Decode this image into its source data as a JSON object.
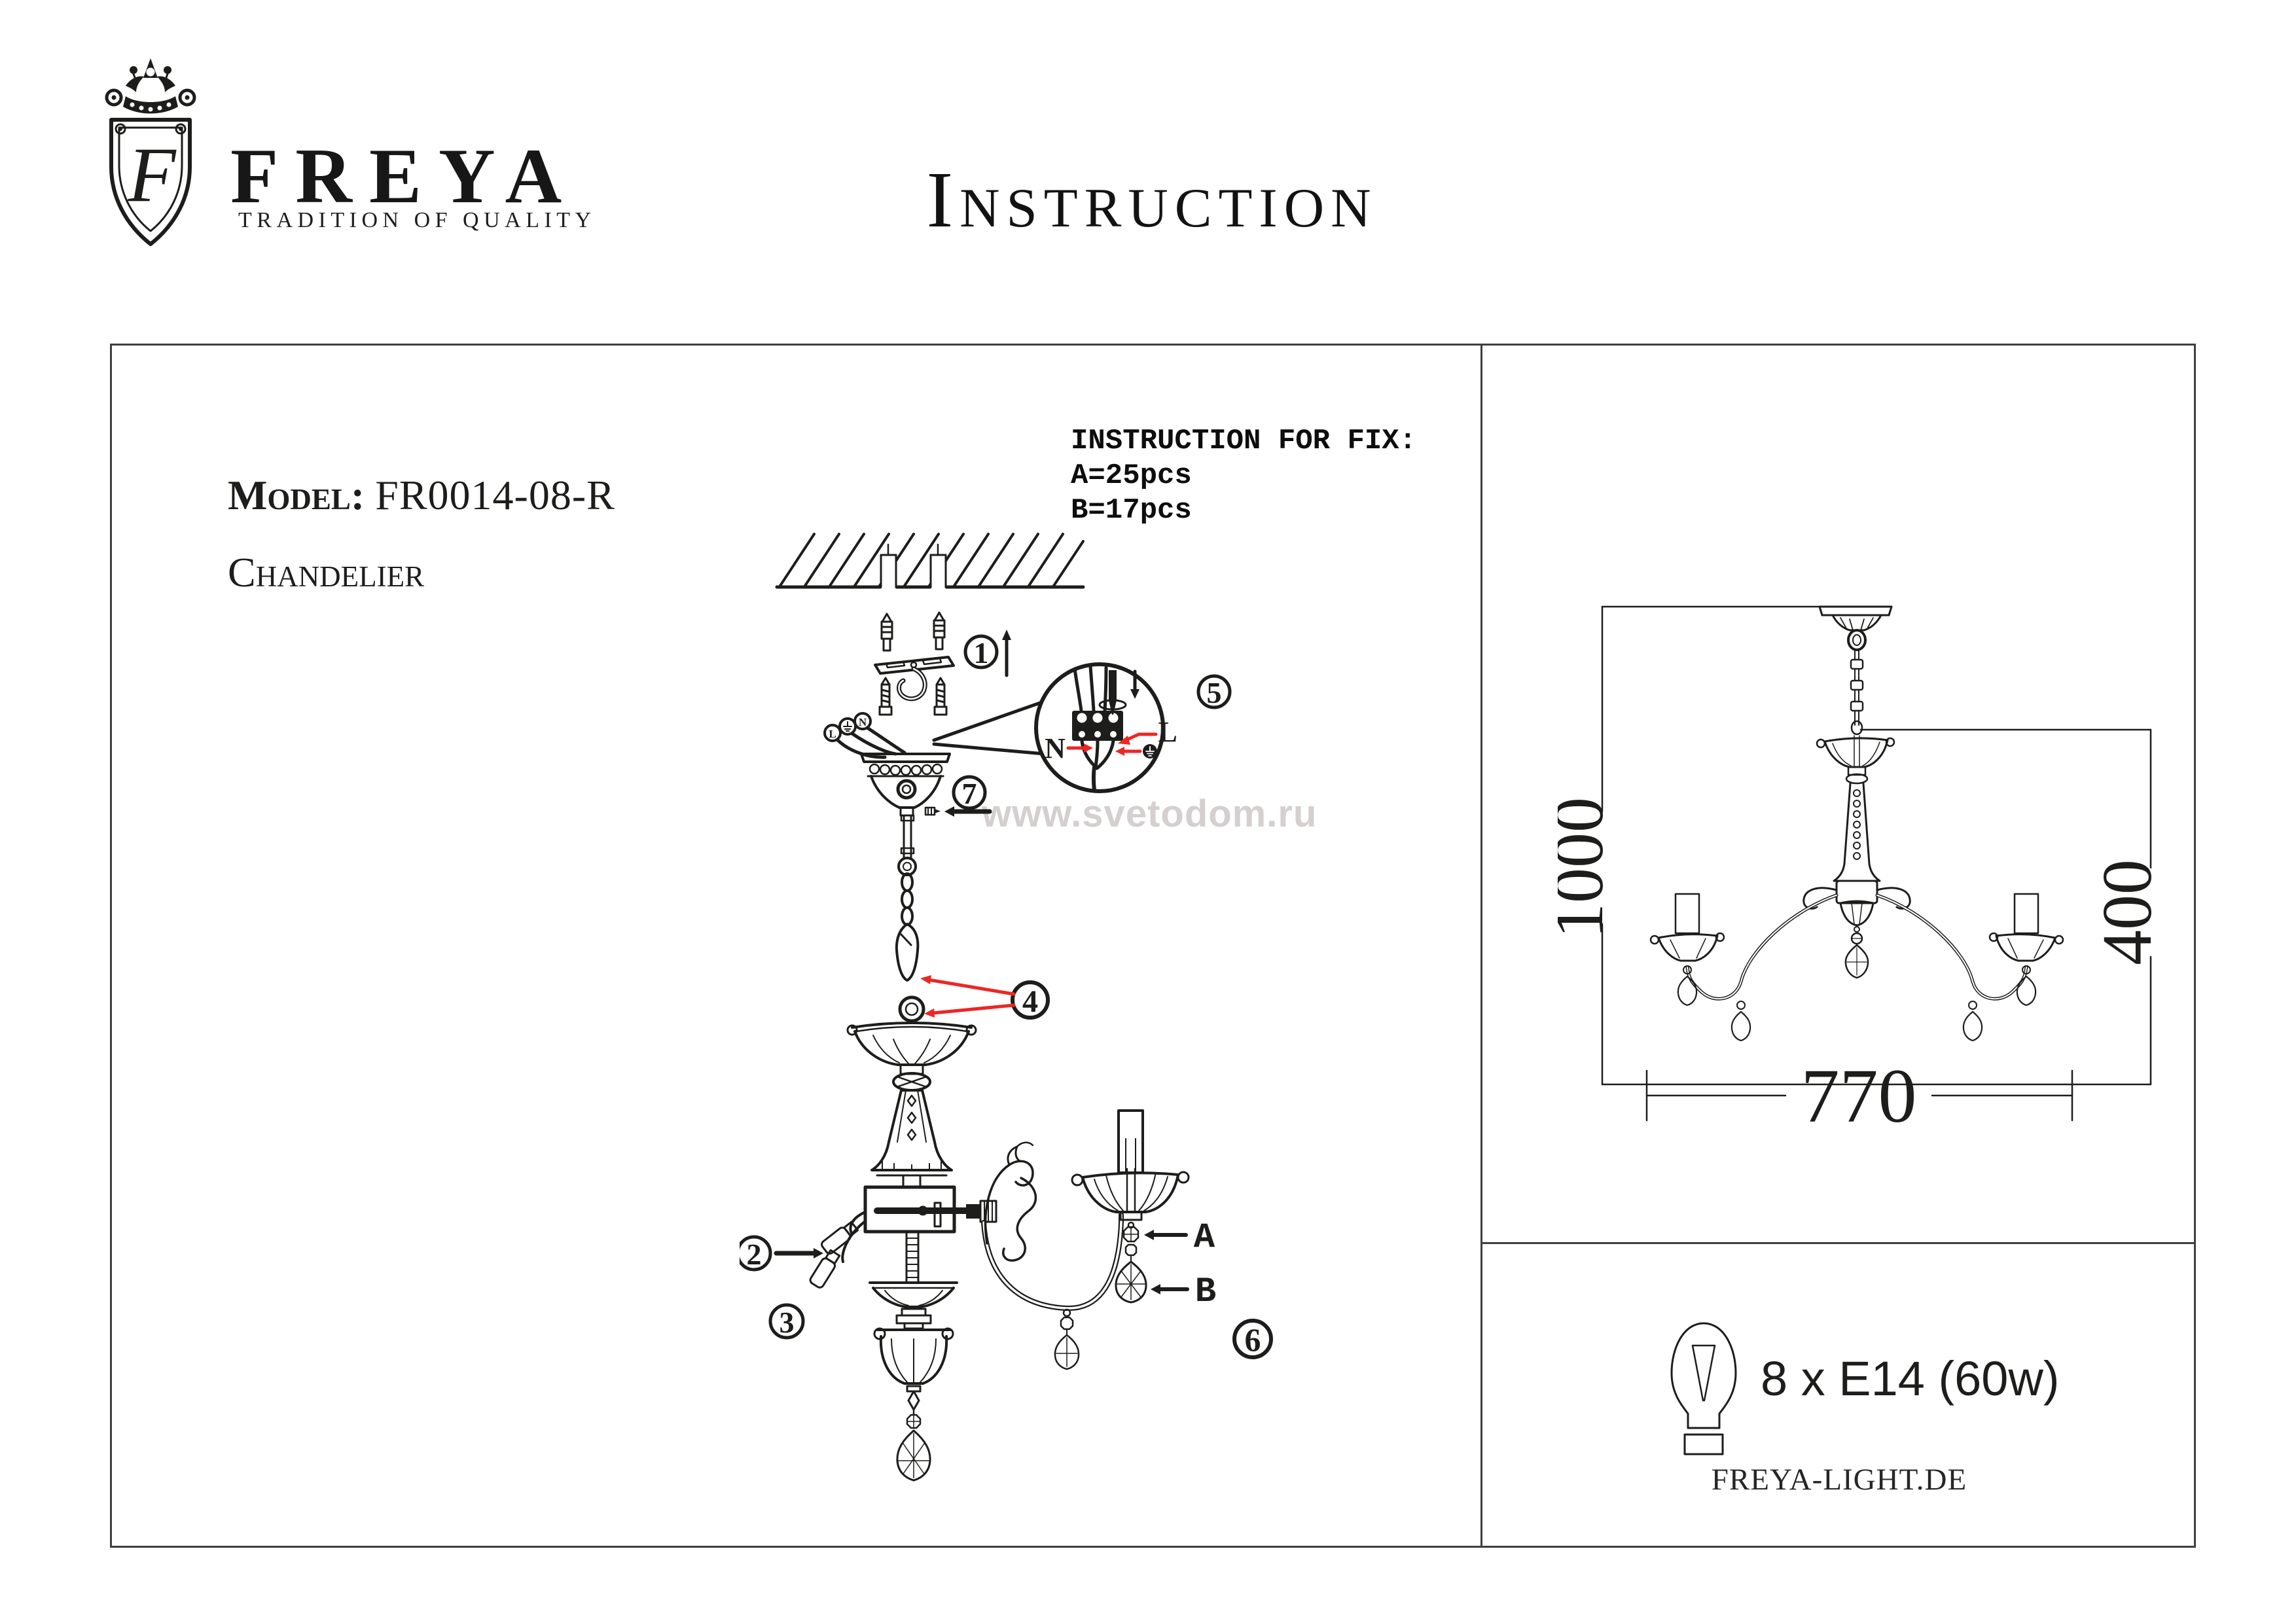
{
  "brand": {
    "name": "FREYA",
    "tagline": "TRADITION OF QUALITY",
    "monogram": "F",
    "website": "FREYA-LIGHT.DE"
  },
  "title": "Instruction",
  "product": {
    "model_label": "Model:",
    "model_number": "FR0014-08-R",
    "type": "Chandelier"
  },
  "fix_note": {
    "title": "INSTRUCTION FOR FIX:",
    "a": "A=25pcs",
    "b": "B=17pcs"
  },
  "watermark": "www.svetodom.ru",
  "assembly": {
    "callouts": [
      "1",
      "2",
      "3",
      "4",
      "5",
      "6",
      "7"
    ],
    "wiring": {
      "neutral": "N",
      "live": "L"
    },
    "parts": {
      "a": "A",
      "b": "B"
    }
  },
  "dimensions": {
    "overall_height": "1000",
    "body_height": "400",
    "width": "770"
  },
  "spec": {
    "lamps": "8 x E14 (60w)"
  },
  "colors": {
    "ink": "#1d1d1b",
    "accent_red": "#ec2723",
    "watermark": "#d5cfcf",
    "frame": "#3f3f3f"
  }
}
